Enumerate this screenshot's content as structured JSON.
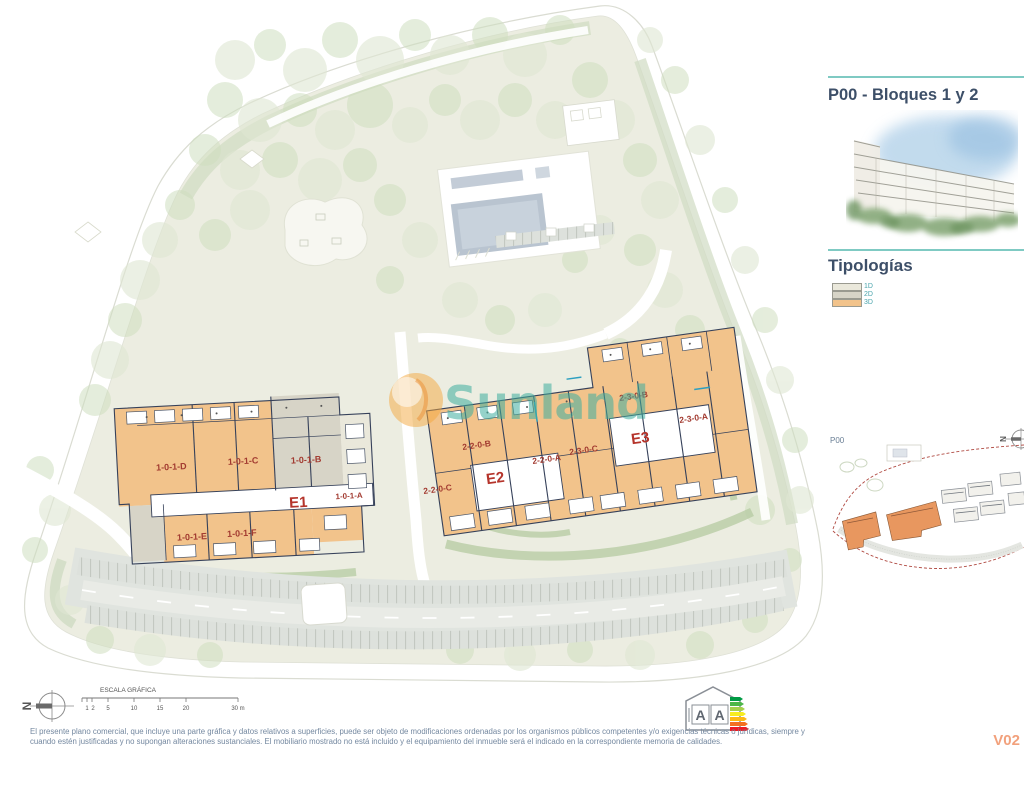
{
  "panel": {
    "title": "P00 - Bloques 1 y 2",
    "typologies_heading": "Tipologías",
    "legend": [
      {
        "label": "1D",
        "color": "#eae8db"
      },
      {
        "label": "2D",
        "color": "#d7d4c7"
      },
      {
        "label": "3D",
        "color": "#f2c38b"
      }
    ],
    "keyplan_label": "P00"
  },
  "watermark": {
    "text": "Sunland"
  },
  "plan": {
    "north_letter": "N",
    "units": {
      "b1d": "1-0-1-D",
      "b1c": "1-0-1-C",
      "b1b": "1-0-1-B",
      "b1a": "1-0-1-A",
      "b1e": "1-0-1-E",
      "b1f": "1-0-1-F",
      "b2c": "2-2-0-C",
      "b2b": "2-2-0-B",
      "b2a": "2-2-0-A",
      "b3c": "2-3-0-C",
      "b3b": "2-3-0-B",
      "b3a": "2-3-0-A"
    },
    "cores": {
      "e1": "E1",
      "e2": "E2",
      "e3": "E3"
    }
  },
  "scalebar": {
    "title": "ESCALA GRÁFICA",
    "ticks": [
      "1",
      "2",
      "5",
      "10",
      "15",
      "20",
      "30 m"
    ]
  },
  "energy": {
    "consumption_letter": "A",
    "emissions_letter": "A"
  },
  "footer": {
    "disclaimer_line1": "El presente plano comercial, que incluye una parte gráfica y datos relativos a superficies, puede ser objeto de modificaciones ordenadas por los organismos públicos competentes y/o exigencias técnicas o jurídicas, siempre y",
    "disclaimer_line2": "cuando estén justificadas y no supongan alteraciones sustanciales. El mobiliario mostrado no está incluido y el equipamiento del inmueble será el indicado en la correspondiente memoria de calidades.",
    "version": "V02"
  },
  "colors": {
    "title_text": "#3d4f68",
    "teal_divider": "#7fcac3",
    "legend_text": "#4aa4ac",
    "unit_label": "#a23a30",
    "core_label": "#b5342b",
    "watermark_teal": "#3fae9f",
    "watermark_orange": "#f3a73e",
    "typology_1d": "#eae8db",
    "typology_2d": "#d7d4c7",
    "typology_3d": "#f2c38b",
    "version_text": "#f2a17c",
    "keyplan_boundary": "#b04a42",
    "keyplan_highlight": "#e8975f"
  }
}
